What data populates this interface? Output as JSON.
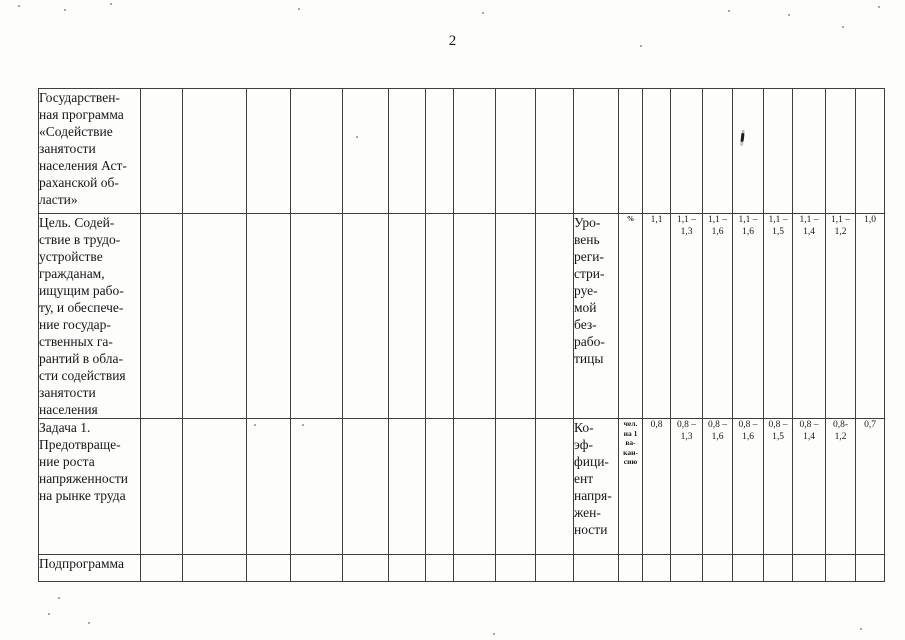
{
  "page_number": "2",
  "table": {
    "layout": {
      "columns_px": [
        102,
        42,
        64,
        44,
        52,
        46,
        37,
        28,
        42,
        40,
        38,
        45,
        24,
        28,
        32,
        30,
        31,
        29,
        33,
        30,
        29
      ],
      "row_heights_px": [
        125,
        204,
        136,
        27
      ],
      "empty_columns": 10,
      "value_columns": 8
    },
    "rows": [
      {
        "id": "state-program",
        "title_lines": [
          "Государствен-",
          "ная программа",
          "«Содействие",
          "занятости",
          "населения Аст-",
          "раханской об-",
          "ласти»"
        ],
        "indicator_lines": [],
        "unit_lines": [],
        "values": []
      },
      {
        "id": "goal",
        "title_lines": [
          "Цель. Содей-",
          "ствие в трудо-",
          "устройстве",
          "гражданам,",
          "ищущим рабо-",
          "ту, и обеспече-",
          "ние государ-",
          "ственных га-",
          "рантий в обла-",
          "сти содействия",
          "занятости",
          "населения"
        ],
        "indicator_lines": [
          "Уро-",
          "вень",
          "реги-",
          "стри-",
          "руе-",
          "мой",
          "без-",
          "рабо-",
          "тицы"
        ],
        "unit_lines": [
          "%"
        ],
        "values": [
          [
            "1,1"
          ],
          [
            "1,1 –",
            "1,3"
          ],
          [
            "1,1 –",
            "1,6"
          ],
          [
            "1,1 –",
            "1,6"
          ],
          [
            "1,1 –",
            "1,5"
          ],
          [
            "1,1 –",
            "1,4"
          ],
          [
            "1,1 –",
            "1,2"
          ],
          [
            "1,0"
          ]
        ]
      },
      {
        "id": "task-1",
        "title_lines": [
          "Задача 1.",
          "Предотвраще-",
          "ние роста",
          "напряженности",
          "на рынке труда"
        ],
        "indicator_lines": [
          "Ко-",
          "эф-",
          "фици-",
          "ент",
          "напря-",
          "жен-",
          "ности"
        ],
        "unit_lines": [
          "чел.",
          "на 1",
          "ва-",
          "кан-",
          "сию"
        ],
        "values": [
          [
            "0,8"
          ],
          [
            "0,8 –",
            "1,3"
          ],
          [
            "0,8 –",
            "1,6"
          ],
          [
            "0,8 –",
            "1,6"
          ],
          [
            "0,8 –",
            "1,5"
          ],
          [
            "0,8 –",
            "1,4"
          ],
          [
            "0,8-",
            "1,2"
          ],
          [
            "0,7"
          ]
        ]
      },
      {
        "id": "subprogram",
        "title_lines": [
          "Подпрограмма"
        ],
        "indicator_lines": [],
        "unit_lines": [],
        "values": []
      }
    ]
  }
}
